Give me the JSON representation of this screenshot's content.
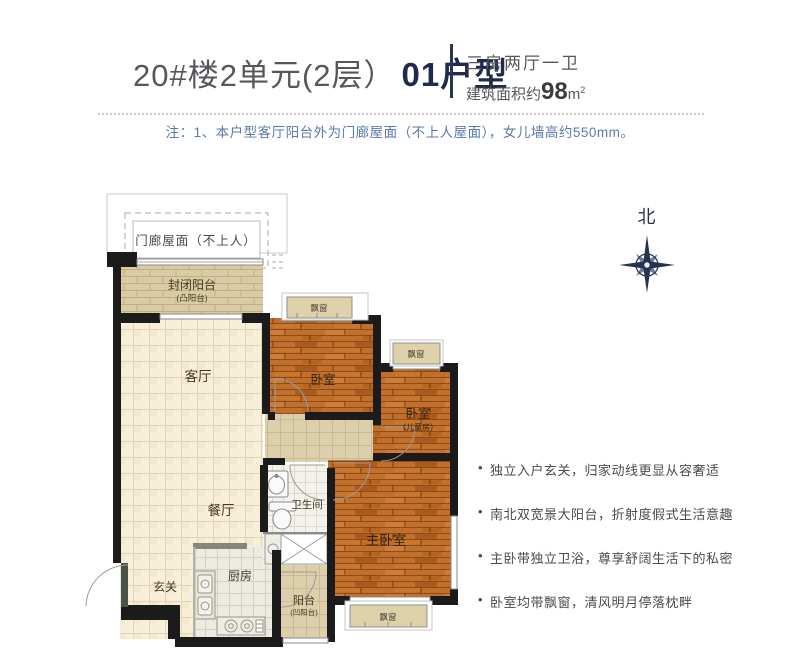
{
  "header": {
    "title_regular": "20#楼2单元(2层）",
    "title_bold": "01户型",
    "layout_type": "三房两厅一卫",
    "area_prefix": "建筑面积约",
    "area_value": "98",
    "area_unit": "m",
    "area_sup": "2"
  },
  "note": "注：1、本户型客厅阳台外为门廊屋面（不上人屋面），女儿墙高约550mm。",
  "compass": {
    "north_label": "北"
  },
  "rooms": {
    "porch_roof": "门廊屋面（不上人）",
    "enclosed_balcony": "封闭阳台",
    "enclosed_balcony_sub": "(凸阳台)",
    "living": "客厅",
    "dining": "餐厅",
    "entry": "玄关",
    "kitchen": "厨房",
    "bathroom": "卫生间",
    "bedroom1": "卧室",
    "bedroom2": "卧室",
    "bedroom2_sub": "（儿童房）",
    "master_bedroom": "主卧室",
    "balcony": "阳台",
    "balcony_sub": "(凹阳台)",
    "bay_window": "飘窗"
  },
  "bullets": [
    "独立入户玄关，归家动线更显从容奢适",
    "南北双宽景大阳台，折射度假式生活意趣",
    "主卧带独立卫浴，尊享舒阔生活下的私密",
    "卧室均带飘窗，清风明月停落枕畔"
  ],
  "colors": {
    "accent_navy": "#1f2a4d",
    "note_blue": "#5a79ac",
    "wood_floor": "#c06f2d",
    "tile_floor": "#f7efda",
    "wall_black": "#1b1b1b"
  }
}
